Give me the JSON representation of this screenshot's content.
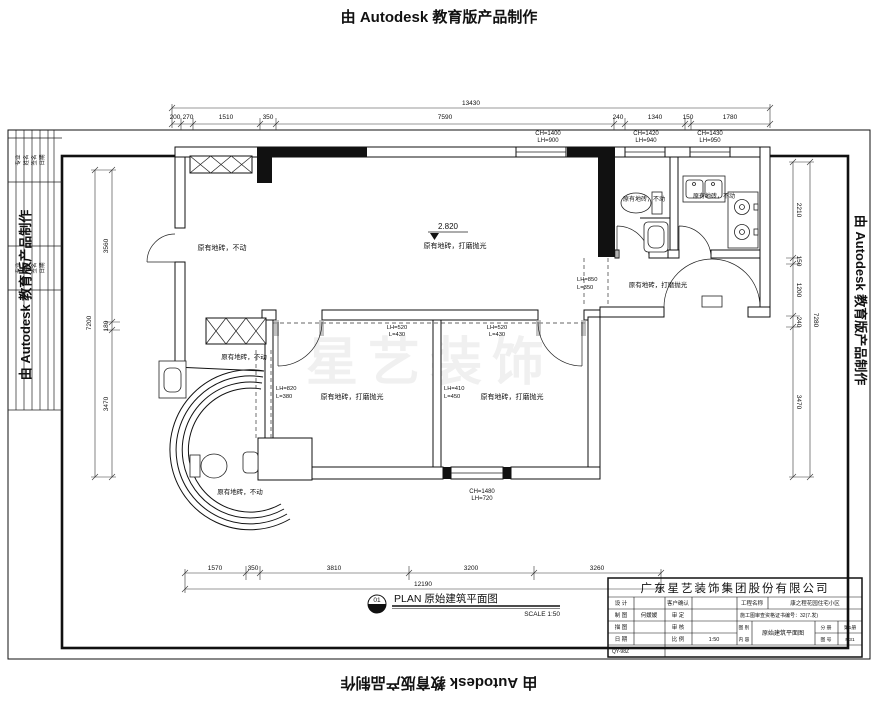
{
  "watermarks": {
    "top": "由 Autodesk 教育版产品制作",
    "bottom": "由 Autodesk 教育版产品制作",
    "left": "由 Autodesk 教育版产品制作",
    "right": "由 Autodesk 教育版产品制作"
  },
  "sign_strip": {
    "labels": [
      "专业",
      "姓名",
      "签名",
      "日期"
    ]
  },
  "faint_logo": "星艺装饰",
  "dims": {
    "top_total": "13430",
    "top_segments": [
      "200",
      "270",
      "1510",
      "350",
      "7590",
      "240",
      "1340",
      "150",
      "1780"
    ],
    "bottom_segments": [
      "1570",
      "350",
      "3810",
      "3200",
      "3260"
    ],
    "bottom_total": "12190",
    "left_segments": [
      "3560",
      "180",
      "3470"
    ],
    "left_total": "7200",
    "right_segments": [
      "2210",
      "150",
      "1200",
      "240",
      "3470"
    ],
    "right_total": "7280"
  },
  "windows": [
    {
      "ch": "CH=1400",
      "lh": "LH=900"
    },
    {
      "ch": "CH=1420",
      "lh": "LH=940"
    },
    {
      "ch": "CH=1430",
      "lh": "LH=950"
    },
    {
      "ch": "CH=1480",
      "lh": "LH=720"
    }
  ],
  "beams": [
    {
      "l1": "LH=520",
      "l2": "L=430"
    },
    {
      "l1": "LH=520",
      "l2": "L=430"
    },
    {
      "l1": "LH=820",
      "l2": "L=380"
    },
    {
      "l1": "LH=410",
      "l2": "L=450"
    },
    {
      "l1": "LH=850",
      "l2": "L=350"
    }
  ],
  "level": {
    "value": "2.820"
  },
  "notes": [
    "原有地砖，不动",
    "原有地砖，打磨抛光",
    "原有地砖，不动",
    "原有地砖，不动",
    "原有地砖，打磨抛光",
    "原有地砖，打磨抛光",
    "原有地砖，打磨抛光",
    "原有地砖，不动",
    "原有地砖，不动"
  ],
  "plan_title": {
    "number": "01",
    "label": "PLAN 原始建筑平面图",
    "scale": "SCALE 1:50"
  },
  "titleblock": {
    "company": "广东星艺装饰集团股份有限公司",
    "fields": {
      "design_label": "设 计",
      "design_value": "",
      "client_label": "客户确认",
      "client_value": "",
      "project_label": "工程名称",
      "project_value": "康之程花园住宅小区",
      "draft_label": "制 图",
      "draft_value": "何媛媛",
      "approve_label": "审 定",
      "approve_value": "",
      "cert_text": "施工图审查资格证书编号：32(7.发)",
      "trace_label": "描 图",
      "trace_value": "",
      "check_label": "审 核",
      "check_value": "",
      "category_label": "图 别",
      "content_label": "内 容",
      "drawing_name": "原始建筑平面图",
      "volume_label": "分 册",
      "volume_value": "第1册",
      "sheet_label": "图 号",
      "sheet_value": "P.31",
      "date_label": "日 期",
      "date_value": "",
      "scale_label": "比 例",
      "scale_value": "1:50",
      "archive_no": "QY-98Z"
    }
  }
}
